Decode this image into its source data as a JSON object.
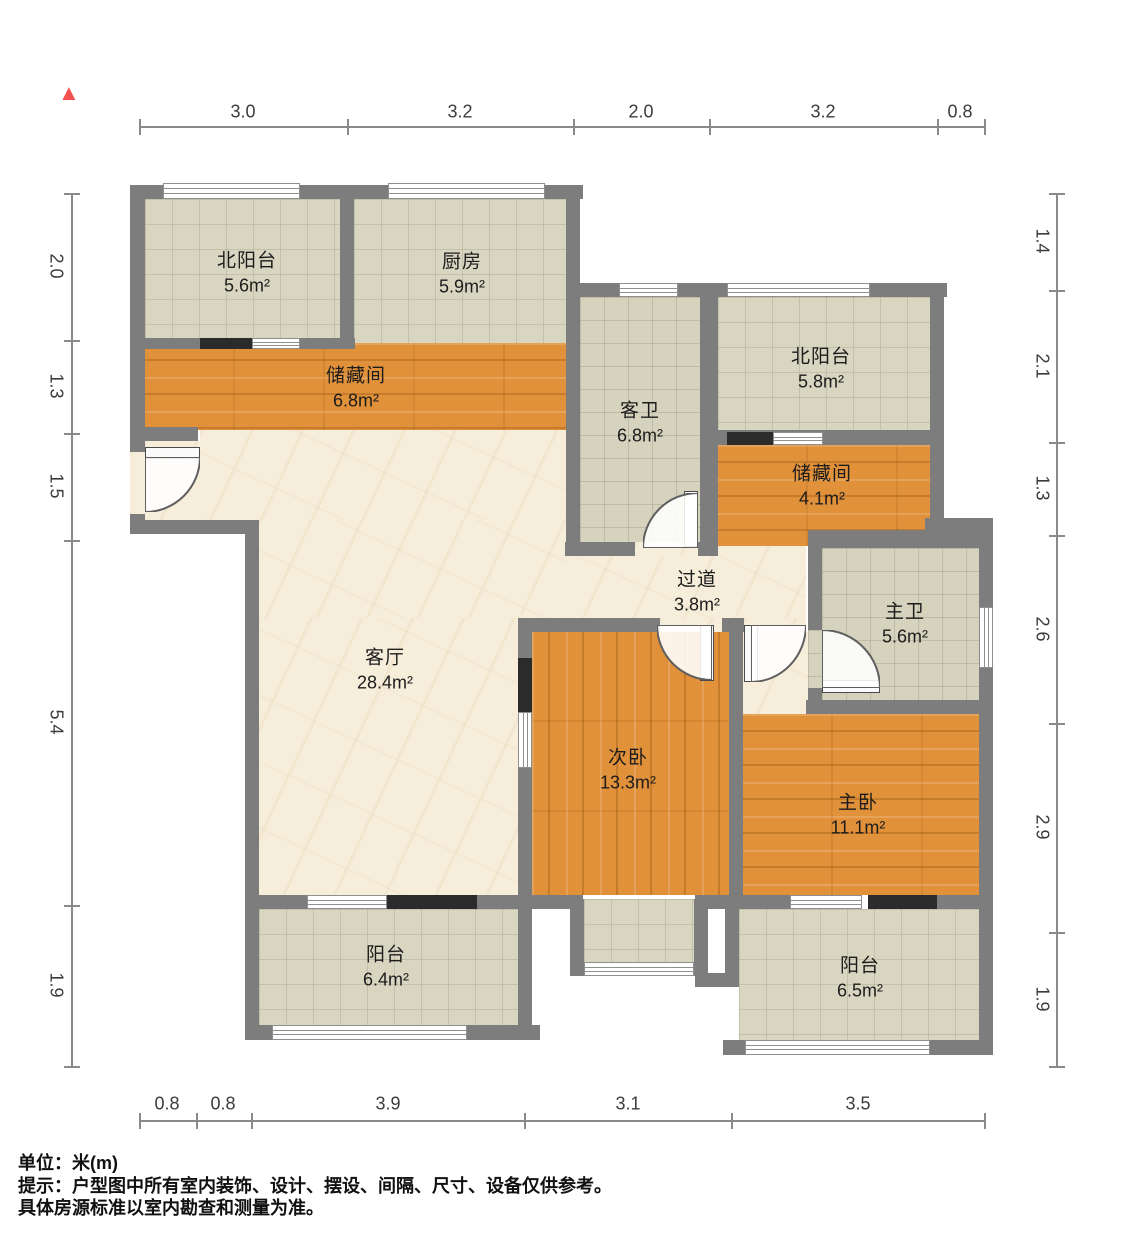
{
  "north_indicator": "▲",
  "rooms": {
    "north_balcony_nw": {
      "name": "北阳台",
      "area": "5.6m²"
    },
    "kitchen": {
      "name": "厨房",
      "area": "5.9m²"
    },
    "storage_main": {
      "name": "储藏间",
      "area": "6.8m²"
    },
    "guest_bath": {
      "name": "客卫",
      "area": "6.8m²"
    },
    "north_balcony_ne": {
      "name": "北阳台",
      "area": "5.8m²"
    },
    "storage_small": {
      "name": "储藏间",
      "area": "4.1m²"
    },
    "hallway": {
      "name": "过道",
      "area": "3.8m²"
    },
    "master_bath": {
      "name": "主卫",
      "area": "5.6m²"
    },
    "living_room": {
      "name": "客厅",
      "area": "28.4m²"
    },
    "second_bedroom": {
      "name": "次卧",
      "area": "13.3m²"
    },
    "master_bedroom": {
      "name": "主卧",
      "area": "11.1m²"
    },
    "balcony_sw": {
      "name": "阳台",
      "area": "6.4m²"
    },
    "balcony_se": {
      "name": "阳台",
      "area": "6.5m²"
    }
  },
  "dimensions": {
    "top": [
      "3.0",
      "3.2",
      "2.0",
      "3.2",
      "0.8"
    ],
    "left": [
      "2.0",
      "1.3",
      "1.5",
      "5.4",
      "1.9"
    ],
    "right": [
      "1.4",
      "2.1",
      "1.3",
      "2.6",
      "2.9",
      "1.9"
    ],
    "bottom": [
      "0.8",
      "0.8",
      "3.9",
      "3.1",
      "3.5"
    ]
  },
  "notes": {
    "unit": "单位：米(m)",
    "tip1": "提示：户型图中所有室内装饰、设计、摆设、间隔、尺寸、设备仅供参考。",
    "tip2": "具体房源标准以室内勘查和测量为准。"
  },
  "colors": {
    "wall": "#7d7d7d",
    "wood": "#e0913a",
    "tile": "#d8d5c0",
    "tile_bath": "#d5d2bd",
    "cream": "#f6eedb",
    "panel_black": "#2b2b2b",
    "north_red": "#f25151"
  }
}
